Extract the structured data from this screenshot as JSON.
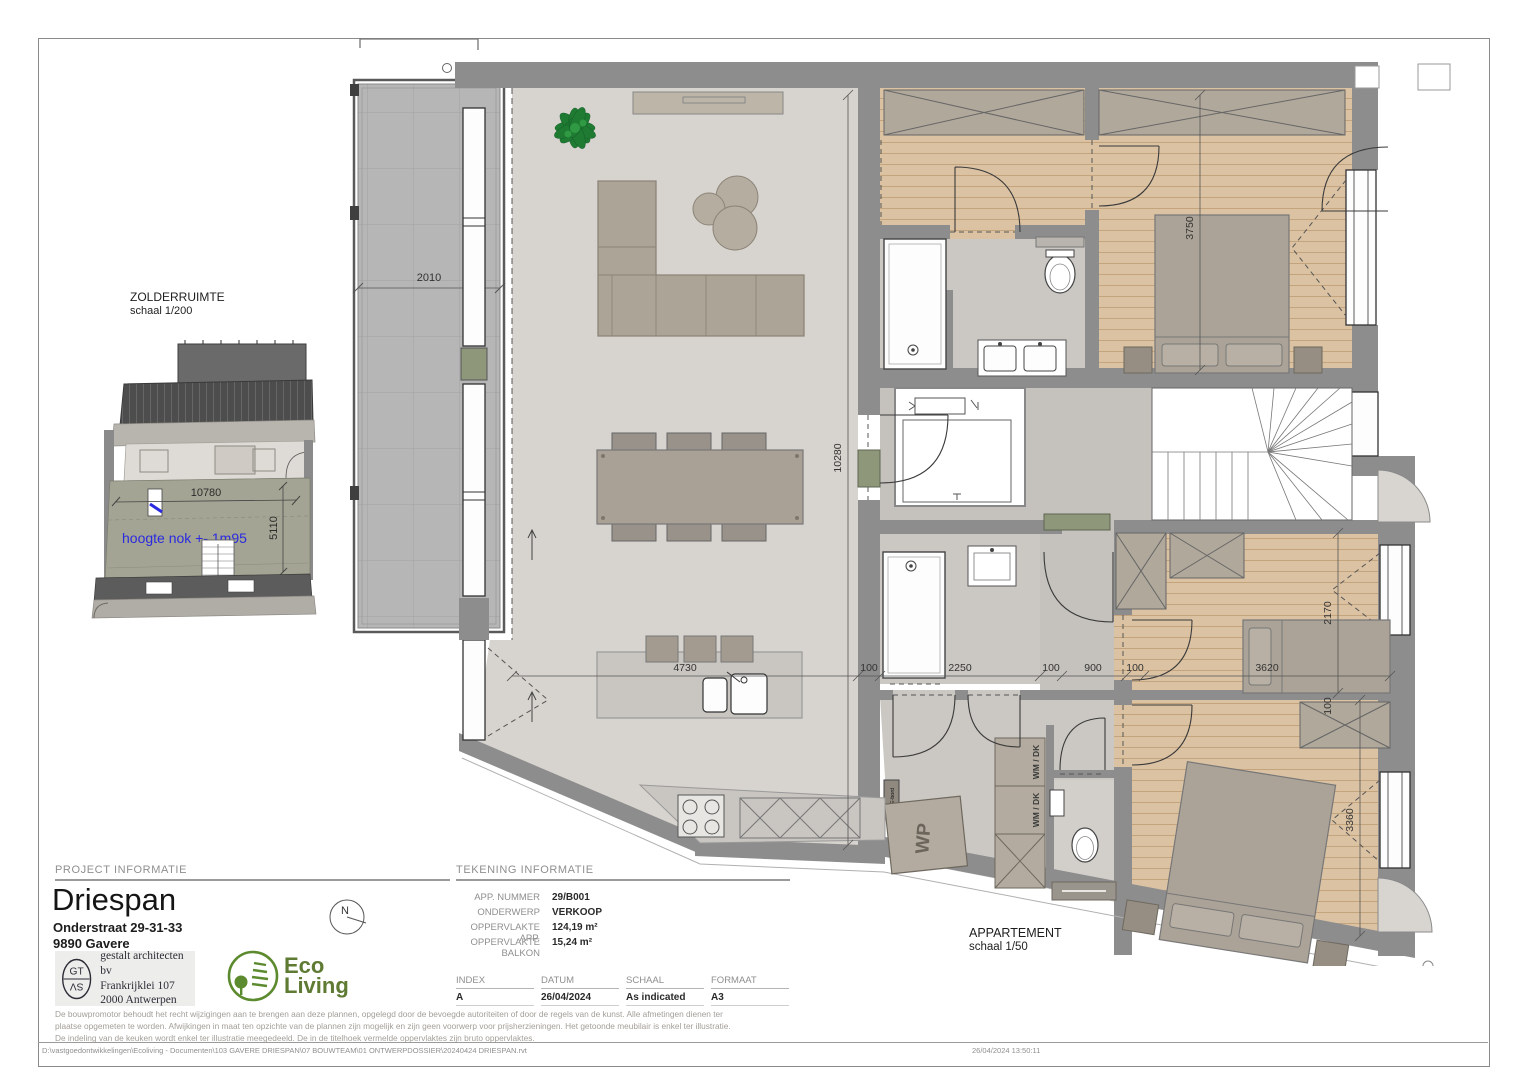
{
  "sheet": {
    "footer_path": "D:\\vastgoedontwikkelingen\\Ecoliving - Documenten\\103 GAVERE DRIESPAN\\07 BOUWTEAM\\01 ONTWERPDOSSIER\\20240424 DRIESPAN.rvt",
    "footer_timestamp": "26/04/2024 13:50:11"
  },
  "zolder_plan": {
    "title": "ZOLDERRUIMTE",
    "scale": "schaal 1/200",
    "dim_width": "10780",
    "dim_depth": "5110",
    "note": "hoogte nok +- 1m95"
  },
  "apartment_plan": {
    "title": "APPARTEMENT",
    "scale": "schaal 1/50",
    "labels": {
      "wp": "WP",
      "wm_dk": "WM / DK",
      "e_bord": "E-bord"
    },
    "dims": {
      "balcony": "2010",
      "living": "10280",
      "kitchen": "4730",
      "master": "3750",
      "bed2_depth": "2170",
      "bed2_width": "3620",
      "bed3_depth": "3360",
      "wall": "100",
      "bath": "2250",
      "hall": "900"
    }
  },
  "project_info": {
    "section_title": "PROJECT INFORMATIE",
    "title": "Driespan",
    "address_line1": "Onderstraat 29-31-33",
    "address_line2": "9890 Gavere",
    "architect_name": "gestalt architecten bv",
    "architect_address1": "Frankrijklei 107",
    "architect_address2": "2000 Antwerpen",
    "architect_monogram_top": "GT",
    "architect_monogram_bottom": "SV",
    "north_label": "N",
    "logo_text_top": "Eco",
    "logo_text_bottom": "Living"
  },
  "drawing_info": {
    "section_title": "TEKENING INFORMATIE",
    "fields": [
      {
        "label": "APP. NUMMER",
        "value": "29/B001"
      },
      {
        "label": "ONDERWERP",
        "value": "VERKOOP"
      },
      {
        "label": "OPPERVLAKTE APP.",
        "value": "124,19 m²"
      },
      {
        "label": "OPPERVLAKTE BALKON",
        "value": "15,24 m²"
      }
    ],
    "meta": [
      {
        "label": "INDEX",
        "value": "A"
      },
      {
        "label": "DATUM",
        "value": "26/04/2024"
      },
      {
        "label": "SCHAAL",
        "value": "As indicated"
      },
      {
        "label": "FORMAAT",
        "value": "A3"
      }
    ]
  },
  "disclaimer": "De bouwpromotor behoudt het recht wijzigingen aan te brengen aan deze plannen, opgelegd door de bevoegde autoriteiten of door de regels van de kunst. Alle afmetingen dienen ter plaatse opgemeten te worden. Afwijkingen in maat ten opzichte van de plannen zijn mogelijk en zijn geen voorwerp voor prijsherzieningen. Het getoonde meubilair is enkel ter illustratie. De indeling van de keuken wordt enkel ter illustratie meegedeeld. De in de titelhoek vermelde oppervlaktes zijn bruto oppervlaktes."
}
